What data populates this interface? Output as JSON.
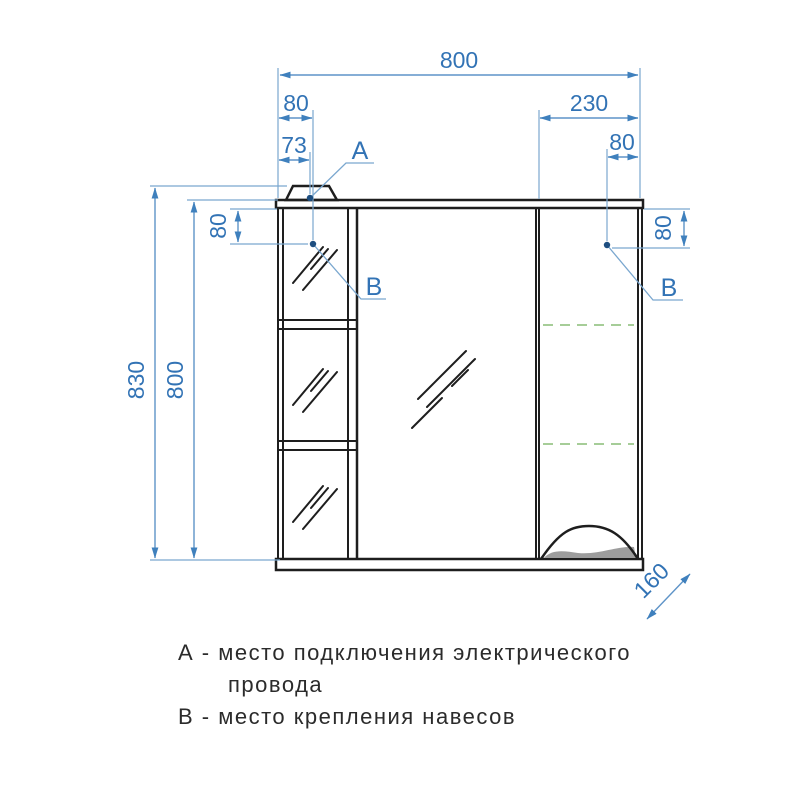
{
  "drawing": {
    "type": "furniture technical drawing (mirror cabinet, front view)",
    "dimensions": {
      "overall_width": "800",
      "left_point_offset": "80",
      "right_door_width": "230",
      "lamp_point_offset": "73",
      "right_point_offset": "80",
      "overall_height": "830",
      "body_height": "800",
      "left_point_drop": "80",
      "right_point_drop": "80",
      "depth": "160"
    },
    "labels": {
      "a": "А",
      "b_left": "В",
      "b_right": "В"
    },
    "legend": {
      "line1": "А - место подключения электрического",
      "line2": "провода",
      "line3": "В - место крепления навесов"
    },
    "colors": {
      "dimension_blue": "#3273b5",
      "outline_black": "#1e1e1e",
      "hidden_shelf_green": "#a6cd98",
      "shade_gray": "#9d9d9d"
    }
  }
}
